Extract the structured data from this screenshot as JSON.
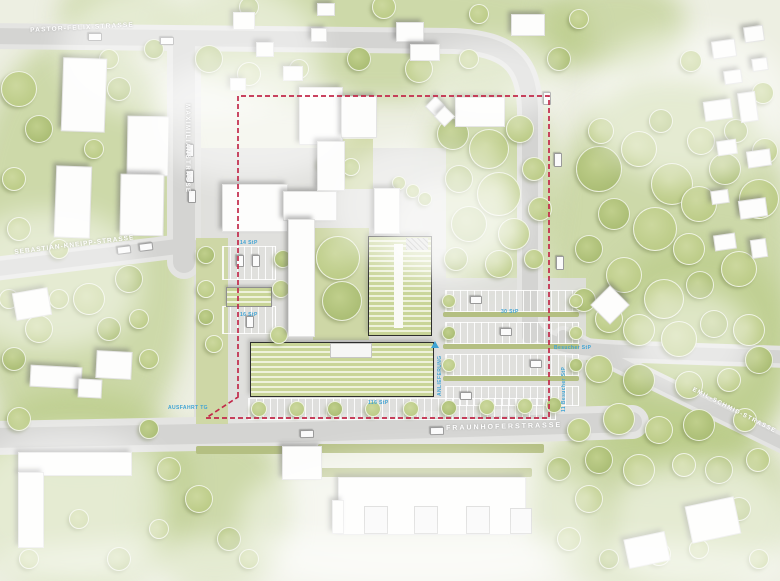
{
  "colors": {
    "boundary": "#c2294a",
    "label_blue": "#3fa3d4",
    "road": "#d5d5d3",
    "tree_fill": "#c2d18f",
    "new_building_stripe": "#c9d598"
  },
  "streets": [
    {
      "text": "PASTOR-FELIX-STRASSE",
      "x": 30,
      "y": 27,
      "rot": -3,
      "fs": 6.5,
      "ls": 1.2
    },
    {
      "text": "MAXIMILIANSTRASSE",
      "x": 190,
      "y": 104,
      "rot": 90,
      "fs": 6,
      "ls": 1.5
    },
    {
      "text": "SEBASTIAN-KNEIPP-STRASSE",
      "x": 14,
      "y": 249,
      "rot": -7,
      "fs": 6.5,
      "ls": 1
    },
    {
      "text": "FRAUNHOFERSTRASSE",
      "x": 446,
      "y": 425,
      "rot": -1.5,
      "fs": 7,
      "ls": 2
    },
    {
      "text": "EMIL-SCHMID-STRASSE",
      "x": 694,
      "y": 387,
      "rot": 27,
      "fs": 6,
      "ls": 1.2
    }
  ],
  "blue_labels": [
    {
      "text": "14 StP",
      "x": 240,
      "y": 240,
      "rot": 0
    },
    {
      "text": "16 StP",
      "x": 240,
      "y": 312,
      "rot": 0
    },
    {
      "text": "30 StP",
      "x": 501,
      "y": 309,
      "rot": 0
    },
    {
      "text": "116 StP",
      "x": 368,
      "y": 400,
      "rot": 0
    },
    {
      "text": "AUSFAHRT TG",
      "x": 168,
      "y": 405,
      "rot": 0
    },
    {
      "text": "Besucher StP",
      "x": 554,
      "y": 345,
      "rot": 0
    },
    {
      "text": "ANLIEFERUNG",
      "x": 437,
      "y": 396,
      "rot": -90
    },
    {
      "text": "11 Besucher StP",
      "x": 561,
      "y": 412,
      "rot": -90
    }
  ],
  "markers": [
    {
      "type": "arrow-up-icon",
      "x": 431,
      "y": 341
    }
  ],
  "landscape": {
    "green": [
      [
        160,
        -30,
        430,
        130
      ],
      [
        -30,
        40,
        220,
        420
      ],
      [
        545,
        80,
        250,
        400
      ],
      [
        425,
        90,
        130,
        200
      ],
      [
        -30,
        390,
        220,
        200
      ],
      [
        530,
        420,
        260,
        170
      ],
      [
        140,
        430,
        150,
        160
      ],
      [
        545,
        -20,
        140,
        90
      ],
      [
        600,
        240,
        190,
        220
      ],
      [
        60,
        -20,
        120,
        70
      ]
    ],
    "fog": [
      [
        60,
        -20,
        260,
        140
      ],
      [
        330,
        140,
        190,
        130
      ],
      [
        -40,
        210,
        180,
        140
      ],
      [
        590,
        30,
        200,
        150
      ],
      [
        240,
        450,
        360,
        140
      ],
      [
        -30,
        430,
        200,
        150
      ],
      [
        610,
        460,
        180,
        130
      ],
      [
        390,
        180,
        130,
        100
      ],
      [
        -10,
        535,
        800,
        60
      ],
      [
        630,
        290,
        120,
        100
      ],
      [
        150,
        60,
        200,
        120
      ],
      [
        420,
        40,
        140,
        80
      ]
    ]
  },
  "paved": [
    [
      194,
      148,
      252,
      280
    ],
    [
      434,
      278,
      152,
      148
    ],
    [
      240,
      394,
      334,
      36
    ]
  ],
  "courtyards": [
    [
      313,
      228,
      56,
      112
    ],
    [
      343,
      139,
      30,
      50
    ],
    [
      196,
      238,
      32,
      186
    ]
  ],
  "parking": [
    [
      222,
      246,
      52,
      32
    ],
    [
      222,
      306,
      52,
      26
    ],
    [
      445,
      290,
      132,
      20
    ],
    [
      445,
      322,
      132,
      20
    ],
    [
      445,
      354,
      132,
      20
    ],
    [
      445,
      386,
      132,
      18
    ],
    [
      248,
      398,
      306,
      20
    ]
  ],
  "hedges": [
    [
      443,
      312,
      136,
      5
    ],
    [
      443,
      344,
      136,
      5
    ],
    [
      443,
      376,
      136,
      5
    ],
    [
      196,
      446,
      110,
      8
    ],
    [
      318,
      444,
      226,
      9
    ],
    [
      310,
      468,
      222,
      9
    ]
  ],
  "buildings": {
    "white": [
      [
        62,
        58,
        42,
        72,
        2
      ],
      [
        127,
        116,
        40,
        58,
        1
      ],
      [
        120,
        174,
        42,
        60,
        1
      ],
      [
        55,
        166,
        34,
        70,
        2
      ],
      [
        233,
        12,
        20,
        16,
        0
      ],
      [
        256,
        42,
        16,
        13,
        0
      ],
      [
        283,
        66,
        18,
        13,
        0
      ],
      [
        311,
        28,
        14,
        12,
        0
      ],
      [
        317,
        3,
        16,
        11,
        0
      ],
      [
        230,
        78,
        14,
        11,
        0
      ],
      [
        396,
        22,
        26,
        18,
        0
      ],
      [
        410,
        44,
        28,
        15,
        0
      ],
      [
        511,
        14,
        32,
        20,
        0
      ],
      [
        712,
        40,
        22,
        16,
        -8
      ],
      [
        744,
        26,
        18,
        14,
        -8
      ],
      [
        724,
        70,
        16,
        12,
        -8
      ],
      [
        752,
        58,
        14,
        11,
        -8
      ],
      [
        704,
        100,
        26,
        18,
        -8
      ],
      [
        739,
        92,
        16,
        28,
        -8
      ],
      [
        717,
        140,
        18,
        13,
        -8
      ],
      [
        747,
        150,
        22,
        15,
        -8
      ],
      [
        711,
        190,
        16,
        12,
        -8
      ],
      [
        739,
        199,
        26,
        17,
        -8
      ],
      [
        714,
        234,
        20,
        14,
        -8
      ],
      [
        751,
        239,
        14,
        17,
        -8
      ],
      [
        455,
        97,
        48,
        28,
        0
      ],
      [
        428,
        99,
        13,
        13,
        45
      ],
      [
        437,
        109,
        13,
        13,
        45
      ],
      [
        596,
        291,
        26,
        26,
        45
      ],
      [
        222,
        184,
        64,
        46,
        0
      ],
      [
        283,
        191,
        52,
        28,
        0
      ],
      [
        288,
        219,
        25,
        116,
        0
      ],
      [
        299,
        87,
        42,
        56,
        0
      ],
      [
        341,
        96,
        34,
        40,
        0
      ],
      [
        317,
        141,
        26,
        48,
        0
      ],
      [
        374,
        188,
        24,
        44,
        0
      ],
      [
        282,
        446,
        38,
        32,
        0
      ],
      [
        338,
        477,
        186,
        56,
        0
      ],
      [
        332,
        500,
        10,
        32,
        0
      ],
      [
        18,
        452,
        112,
        22,
        0
      ],
      [
        18,
        472,
        24,
        74,
        0
      ],
      [
        14,
        290,
        34,
        26,
        -10
      ],
      [
        30,
        366,
        50,
        20,
        3
      ],
      [
        78,
        379,
        22,
        17,
        3
      ],
      [
        96,
        351,
        34,
        26,
        3
      ],
      [
        688,
        501,
        48,
        36,
        -12
      ],
      [
        626,
        535,
        40,
        28,
        -12
      ]
    ],
    "green": [
      [
        368,
        236,
        62,
        98,
        0
      ],
      [
        250,
        342,
        182,
        53,
        0
      ]
    ],
    "green_small": [
      [
        226,
        287,
        44,
        18,
        0
      ]
    ],
    "roofbox": [
      [
        364,
        506,
        22,
        26,
        0
      ],
      [
        414,
        506,
        22,
        26,
        0
      ],
      [
        466,
        506,
        22,
        26,
        0
      ],
      [
        510,
        508,
        20,
        24,
        0
      ],
      [
        330,
        343,
        40,
        13,
        0
      ]
    ],
    "aisle": [
      [
        394,
        244,
        9,
        84,
        0
      ]
    ],
    "hatch": [
      [
        406,
        238,
        22,
        12,
        0
      ]
    ]
  },
  "cars": [
    [
      186,
      144,
      6,
      11,
      0
    ],
    [
      186,
      170,
      6,
      11,
      0
    ],
    [
      188,
      190,
      6,
      11,
      0
    ],
    [
      117,
      246,
      12,
      6,
      -7
    ],
    [
      139,
      243,
      12,
      6,
      -7
    ],
    [
      554,
      153,
      6,
      12,
      0
    ],
    [
      556,
      256,
      6,
      12,
      0
    ],
    [
      543,
      92,
      6,
      11,
      0
    ],
    [
      300,
      430,
      12,
      6,
      -1
    ],
    [
      430,
      427,
      12,
      6,
      -1
    ],
    [
      88,
      33,
      12,
      6,
      0
    ],
    [
      160,
      37,
      12,
      6,
      0
    ],
    [
      236,
      255,
      6,
      10,
      0
    ],
    [
      252,
      255,
      6,
      10,
      0
    ],
    [
      246,
      316,
      6,
      10,
      0
    ],
    [
      470,
      296,
      10,
      6,
      0
    ],
    [
      500,
      328,
      10,
      6,
      0
    ],
    [
      530,
      360,
      10,
      6,
      0
    ],
    [
      460,
      392,
      10,
      6,
      0
    ]
  ],
  "trees": [
    [
      598,
      168,
      22
    ],
    [
      638,
      148,
      17
    ],
    [
      671,
      183,
      20
    ],
    [
      613,
      213,
      15
    ],
    [
      654,
      228,
      21
    ],
    [
      698,
      203,
      17
    ],
    [
      724,
      168,
      15
    ],
    [
      758,
      198,
      19
    ],
    [
      688,
      248,
      15
    ],
    [
      588,
      248,
      13
    ],
    [
      623,
      274,
      17
    ],
    [
      663,
      298,
      19
    ],
    [
      699,
      284,
      13
    ],
    [
      738,
      268,
      17
    ],
    [
      608,
      318,
      13
    ],
    [
      583,
      299,
      11
    ],
    [
      638,
      329,
      15
    ],
    [
      678,
      338,
      17
    ],
    [
      713,
      323,
      13
    ],
    [
      748,
      329,
      15
    ],
    [
      598,
      368,
      13
    ],
    [
      638,
      379,
      15
    ],
    [
      688,
      384,
      13
    ],
    [
      728,
      379,
      11
    ],
    [
      758,
      359,
      13
    ],
    [
      618,
      418,
      15
    ],
    [
      658,
      429,
      13
    ],
    [
      698,
      424,
      15
    ],
    [
      744,
      419,
      11
    ],
    [
      578,
      429,
      11
    ],
    [
      598,
      459,
      13
    ],
    [
      638,
      469,
      15
    ],
    [
      683,
      464,
      11
    ],
    [
      718,
      469,
      13
    ],
    [
      757,
      459,
      11
    ],
    [
      700,
      140,
      13
    ],
    [
      735,
      130,
      11
    ],
    [
      764,
      150,
      12
    ],
    [
      600,
      130,
      12
    ],
    [
      660,
      120,
      11
    ],
    [
      690,
      60,
      10
    ],
    [
      762,
      92,
      10
    ],
    [
      452,
      133,
      15
    ],
    [
      488,
      148,
      19
    ],
    [
      519,
      128,
      13
    ],
    [
      458,
      178,
      13
    ],
    [
      498,
      193,
      21
    ],
    [
      533,
      168,
      11
    ],
    [
      468,
      223,
      17
    ],
    [
      513,
      233,
      15
    ],
    [
      539,
      208,
      11
    ],
    [
      455,
      258,
      11
    ],
    [
      498,
      263,
      13
    ],
    [
      533,
      258,
      9
    ],
    [
      208,
      58,
      13
    ],
    [
      248,
      73,
      11
    ],
    [
      298,
      68,
      9
    ],
    [
      358,
      58,
      11
    ],
    [
      418,
      68,
      13
    ],
    [
      468,
      58,
      9
    ],
    [
      248,
      6,
      9
    ],
    [
      383,
      6,
      11
    ],
    [
      478,
      13,
      9
    ],
    [
      558,
      58,
      11
    ],
    [
      578,
      18,
      9
    ],
    [
      18,
      88,
      17
    ],
    [
      38,
      128,
      13
    ],
    [
      13,
      178,
      11
    ],
    [
      93,
      148,
      9
    ],
    [
      118,
      88,
      11
    ],
    [
      58,
      248,
      9
    ],
    [
      18,
      228,
      11
    ],
    [
      128,
      278,
      13
    ],
    [
      88,
      298,
      15
    ],
    [
      38,
      328,
      13
    ],
    [
      13,
      358,
      11
    ],
    [
      58,
      298,
      9
    ],
    [
      138,
      318,
      9
    ],
    [
      108,
      328,
      11
    ],
    [
      148,
      358,
      9
    ],
    [
      8,
      298,
      9
    ],
    [
      153,
      48,
      9
    ],
    [
      108,
      58,
      9
    ],
    [
      18,
      418,
      11
    ],
    [
      148,
      428,
      9
    ],
    [
      168,
      468,
      11
    ],
    [
      198,
      498,
      13
    ],
    [
      228,
      538,
      11
    ],
    [
      158,
      528,
      9
    ],
    [
      248,
      558,
      9
    ],
    [
      118,
      558,
      11
    ],
    [
      78,
      518,
      9
    ],
    [
      28,
      558,
      9
    ],
    [
      558,
      468,
      11
    ],
    [
      588,
      498,
      13
    ],
    [
      568,
      538,
      11
    ],
    [
      608,
      558,
      9
    ],
    [
      658,
      553,
      11
    ],
    [
      758,
      558,
      9
    ],
    [
      738,
      508,
      11
    ],
    [
      698,
      548,
      9
    ],
    [
      337,
      257,
      21
    ],
    [
      341,
      300,
      19
    ],
    [
      325,
      162,
      8
    ],
    [
      350,
      166,
      8
    ],
    [
      205,
      254,
      8
    ],
    [
      205,
      288,
      8
    ],
    [
      280,
      288,
      8
    ],
    [
      282,
      258,
      8
    ],
    [
      213,
      343,
      8
    ],
    [
      278,
      334,
      8
    ],
    [
      205,
      316,
      7
    ],
    [
      258,
      408,
      7
    ],
    [
      296,
      408,
      7
    ],
    [
      334,
      408,
      7
    ],
    [
      372,
      408,
      7
    ],
    [
      410,
      408,
      7
    ],
    [
      448,
      407,
      7
    ],
    [
      486,
      406,
      7
    ],
    [
      524,
      405,
      7
    ],
    [
      553,
      404,
      7
    ],
    [
      398,
      182,
      6
    ],
    [
      412,
      190,
      6
    ],
    [
      424,
      198,
      6
    ],
    [
      448,
      300,
      6
    ],
    [
      575,
      300,
      6
    ],
    [
      448,
      332,
      6
    ],
    [
      575,
      332,
      6
    ],
    [
      448,
      364,
      6
    ],
    [
      575,
      364,
      6
    ]
  ]
}
